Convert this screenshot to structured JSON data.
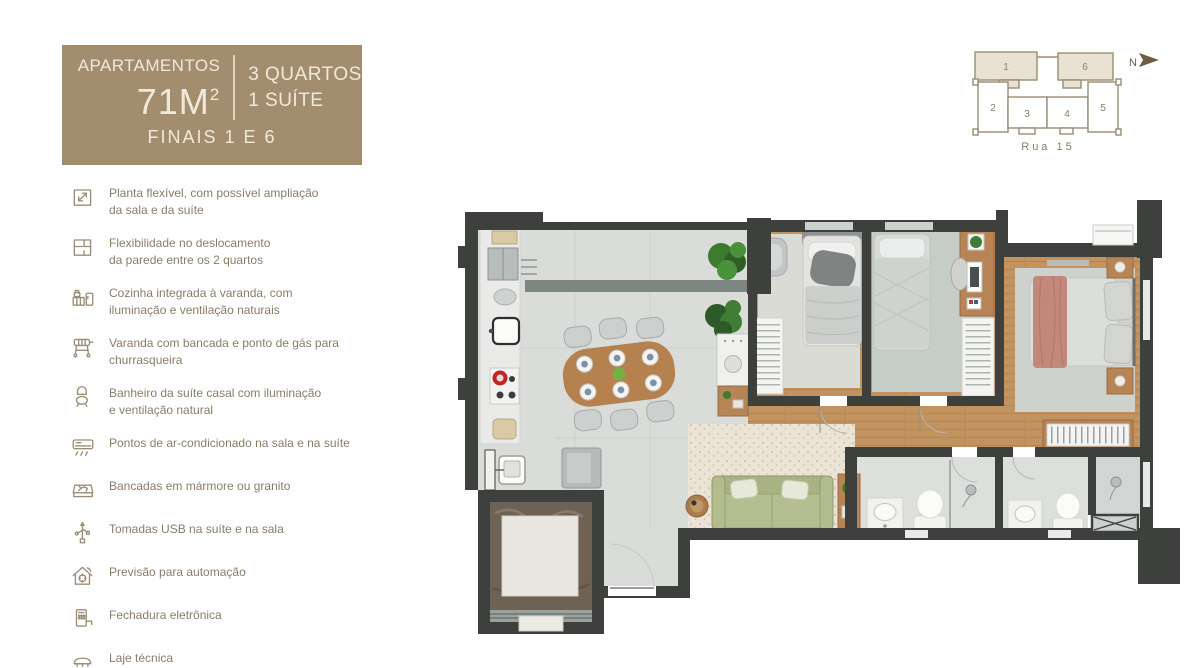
{
  "theme": {
    "header_bg": "#a28e6e",
    "header_text": "#f1e9d8",
    "accent_brown": "#8a7d68",
    "keyplan_line": "#9a8c74",
    "keyplan_fill": "#e8e2d4",
    "north_arrow": "#6d5c40",
    "wall": "#3d403d",
    "floor_gray": "#dadcda",
    "wood": "#c2925f",
    "sofa_green": "#a9b284",
    "bed_pink": "#c2887a"
  },
  "header": {
    "title": "APARTAMENTOS",
    "area": "71M",
    "area_sup": "2",
    "rooms": "3 QUARTOS",
    "suite": "1 SUÍTE",
    "finals": "FINAIS 1 E 6"
  },
  "features": [
    {
      "icon": "expand-plan-icon",
      "line1": "Planta flexível, com possível ampliação",
      "line2": "da sala e da suíte"
    },
    {
      "icon": "wall-flex-icon",
      "line1": "Flexibilidade no deslocamento",
      "line2": "da parede entre os 2 quartos"
    },
    {
      "icon": "kitchen-icon",
      "line1": "Cozinha integrada à varanda, com",
      "line2": "iluminação e ventilação naturais"
    },
    {
      "icon": "grill-icon",
      "line1": "Varanda com bancada e ponto de gás para",
      "line2": "churrasqueira"
    },
    {
      "icon": "toilet-icon",
      "line1": "Banheiro da suíte casal com iluminação",
      "line2": "e ventilação natural"
    },
    {
      "icon": "ac-unit-icon",
      "line1": "Pontos de ar-condicionado na sala e na suíte",
      "line2": ""
    },
    {
      "icon": "countertop-icon",
      "line1": "Bancadas em mármore ou granito",
      "line2": ""
    },
    {
      "icon": "usb-icon",
      "line1": "Tomadas USB na suíte e na sala",
      "line2": ""
    },
    {
      "icon": "home-automation-icon",
      "line1": "Previsão para automação",
      "line2": ""
    },
    {
      "icon": "smart-lock-icon",
      "line1": "Fechadura eletrônica",
      "line2": ""
    },
    {
      "icon": "technical-slab-icon",
      "line1": "Laje técnica",
      "line2": ""
    }
  ],
  "keyplan": {
    "units": [
      "1",
      "2",
      "3",
      "4",
      "5",
      "6"
    ],
    "street": "Rua 15",
    "north": "N"
  }
}
